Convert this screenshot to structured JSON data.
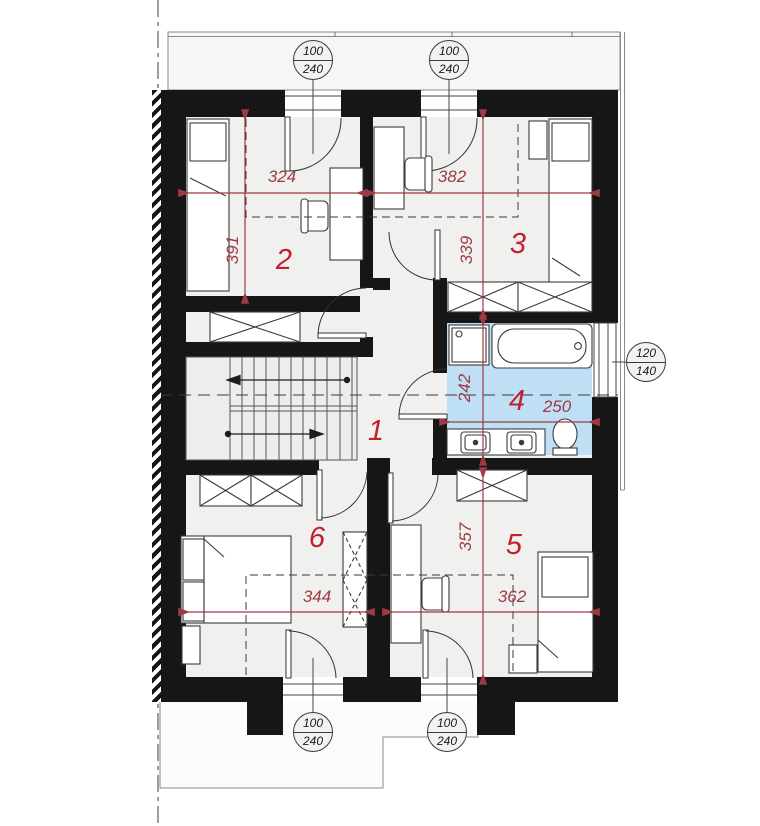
{
  "plan": {
    "title": "attic floor plan",
    "rooms": [
      {
        "id": "room-1",
        "label": "1"
      },
      {
        "id": "room-2",
        "label": "2"
      },
      {
        "id": "room-3",
        "label": "3"
      },
      {
        "id": "room-4",
        "label": "4"
      },
      {
        "id": "room-5",
        "label": "5"
      },
      {
        "id": "room-6",
        "label": "6"
      }
    ],
    "dimensions": {
      "room2_width": "324",
      "room3_width": "382",
      "room2_depth": "391",
      "room3_depth": "339",
      "bath_depth": "242",
      "bath_width": "250",
      "room6_width": "344",
      "room5_width": "362",
      "room5_depth": "357"
    },
    "callouts": [
      {
        "id": "window-top-left",
        "w": "100",
        "h": "240"
      },
      {
        "id": "window-top-right",
        "w": "100",
        "h": "240"
      },
      {
        "id": "window-right",
        "w": "120",
        "h": "140"
      },
      {
        "id": "window-bottom-left",
        "w": "100",
        "h": "240"
      },
      {
        "id": "window-bottom-right",
        "w": "100",
        "h": "240"
      }
    ],
    "colors": {
      "room_number_red": "#c2202f",
      "dimension_red": "#9e3a42",
      "bathroom_blue": "#bfe0f4",
      "wall_black": "#161616"
    }
  }
}
